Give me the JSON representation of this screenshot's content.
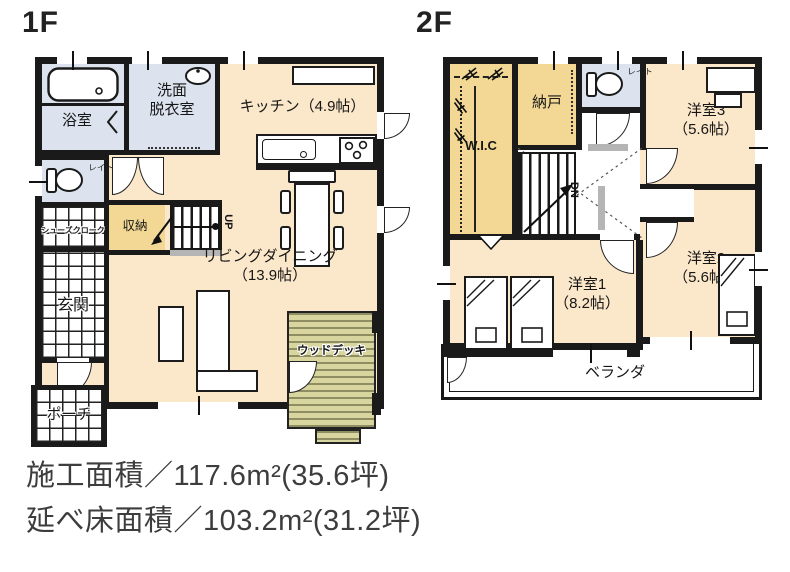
{
  "floor1": {
    "title": "1F",
    "rooms": {
      "bath": "浴室",
      "washroom": "洗面\n脱衣室",
      "kitchen": "キッチン（4.9帖）",
      "toilet": "トイレ",
      "shoes_closet": "シューズクローク",
      "storage": "収納",
      "stairs": "UP",
      "living": "リビングダイニング\n（13.9帖）",
      "entrance": "玄関",
      "porch": "ポーチ",
      "wood_deck": "ウッドデッキ"
    }
  },
  "floor2": {
    "title": "2F",
    "rooms": {
      "wic": "W.I.C",
      "storeroom": "納戸",
      "toilet": "トイレ",
      "stairs": "DN",
      "room3": "洋室3\n（5.6帖）",
      "room2": "洋室2\n（5.6帖）",
      "room1": "洋室1\n（8.2帖）",
      "veranda": "ベランダ"
    }
  },
  "footer": {
    "construction_area": "施工面積／117.6m²(35.6坪)",
    "total_floor_area": "延べ床面積／103.2m²(31.2坪)"
  },
  "colors": {
    "wall": "#1a1a1a",
    "floor": "#fbe7ca",
    "closet": "#f2d894",
    "wet": "#dce3ee",
    "deck": "#d9d59e",
    "deck_stripe": "#8f8d62",
    "rail_gray": "#b5b5b5",
    "text": "#1c1c1c"
  }
}
